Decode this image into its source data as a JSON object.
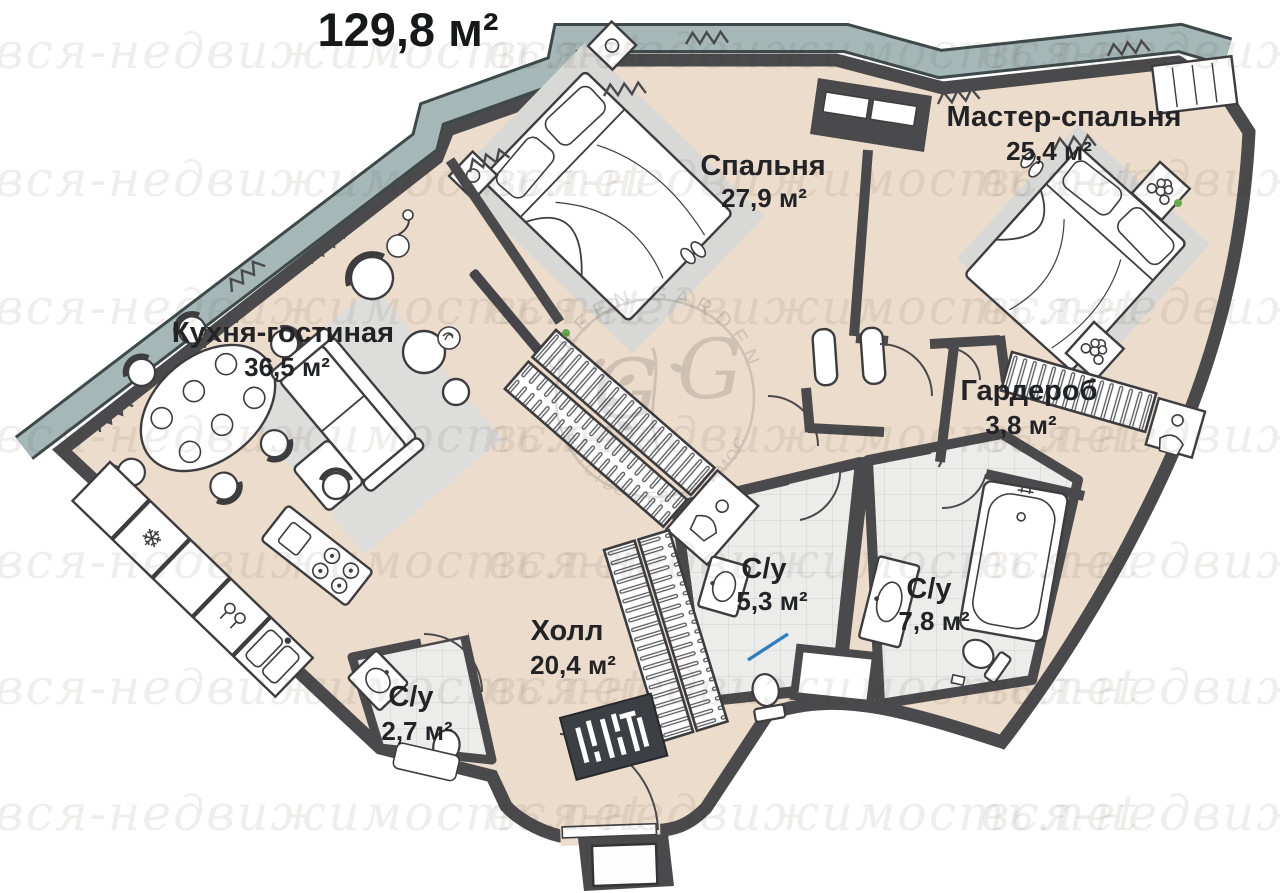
{
  "title": "129,8 м²",
  "watermark": {
    "text": "вся-недвижимость.net"
  },
  "logo": {
    "arc_top": "GREEN GARDEN",
    "arc_bottom": "АГЕНТСТВО НЕДВИЖИМОСТИ",
    "monogram_left": "G",
    "monogram_right": "G"
  },
  "rooms": {
    "kitchen_living": {
      "name": "Кухня-гостиная",
      "area": "36,5 м²"
    },
    "bedroom": {
      "name": "Спальня",
      "area": "27,9 м²"
    },
    "master_bedroom": {
      "name": "Мастер-спальня",
      "area": "25,4 м²"
    },
    "wardrobe": {
      "name": "Гардероб",
      "area": "3,8 м²"
    },
    "hall": {
      "name": "Холл",
      "area": "20,4 м²"
    },
    "bathroom_1": {
      "name": "С/у",
      "area": "5,3 м²"
    },
    "bathroom_2": {
      "name": "С/у",
      "area": "7,8 м²"
    },
    "bathroom_3": {
      "name": "С/у",
      "area": "2,7 м²"
    }
  },
  "icons": {
    "freezer": "❄"
  },
  "colors": {
    "wall": "#4a4a4c",
    "floor": "#ecdccb",
    "facade_band": "#a5b8b7",
    "bathroom_tile": "#ececea",
    "rug": "#d8d8d6",
    "accent_blue": "#2e7fc0",
    "plant_green": "#6aa84f"
  }
}
